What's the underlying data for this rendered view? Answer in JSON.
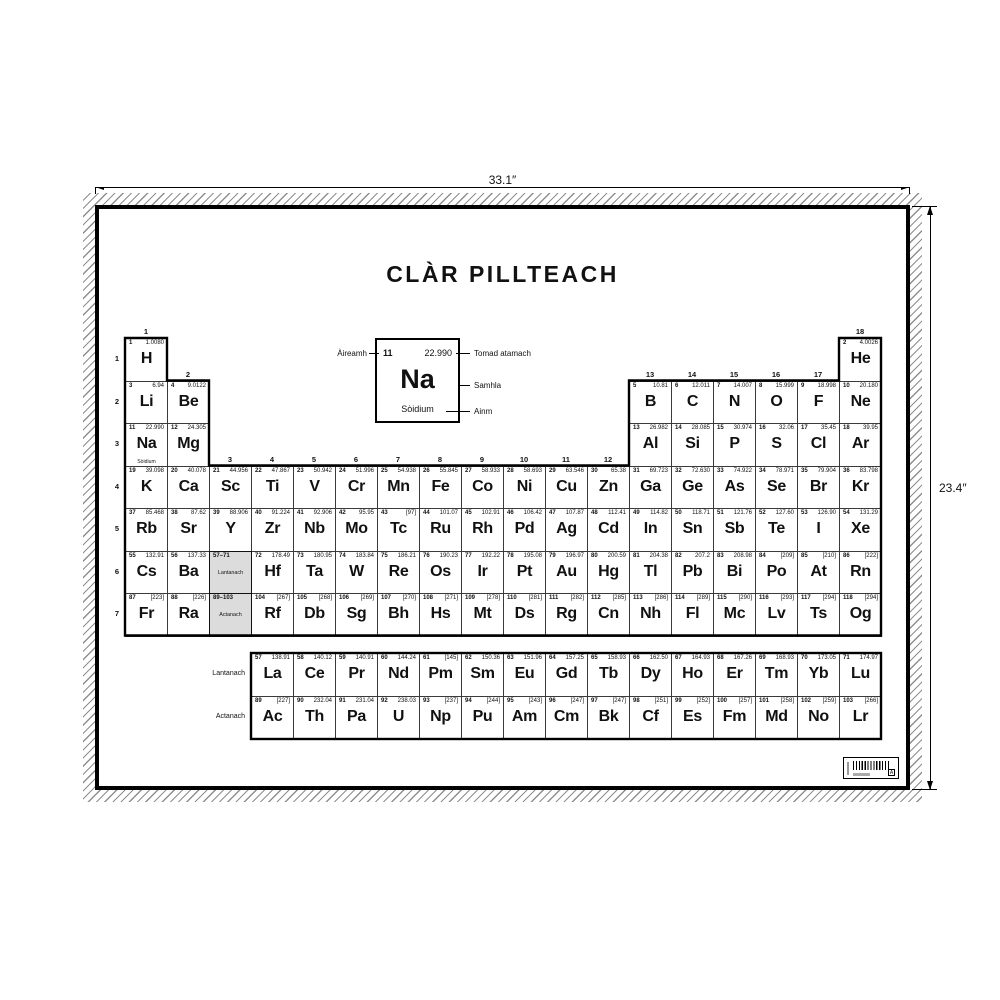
{
  "poster": {
    "title": "CLÀR PILLTEACH",
    "width_label": "33.1″",
    "height_label": "23.4″"
  },
  "legend": {
    "number": "11",
    "mass": "22.990",
    "symbol": "Na",
    "name": "Sòidium",
    "number_label": "Àireamh",
    "mass_label": "Tomad atamach",
    "symbol_label": "Samhla",
    "name_label": "Ainm"
  },
  "table": {
    "period_labels": [
      "1",
      "2",
      "3",
      "4",
      "5",
      "6",
      "7"
    ],
    "group_labels": [
      {
        "g": "1",
        "c": 1,
        "r": 1
      },
      {
        "g": "18",
        "c": 18,
        "r": 1
      },
      {
        "g": "2",
        "c": 2,
        "r": 2
      },
      {
        "g": "13",
        "c": 13,
        "r": 2
      },
      {
        "g": "14",
        "c": 14,
        "r": 2
      },
      {
        "g": "15",
        "c": 15,
        "r": 2
      },
      {
        "g": "16",
        "c": 16,
        "r": 2
      },
      {
        "g": "17",
        "c": 17,
        "r": 2
      },
      {
        "g": "3",
        "c": 3,
        "r": 4
      },
      {
        "g": "4",
        "c": 4,
        "r": 4
      },
      {
        "g": "5",
        "c": 5,
        "r": 4
      },
      {
        "g": "6",
        "c": 6,
        "r": 4
      },
      {
        "g": "7",
        "c": 7,
        "r": 4
      },
      {
        "g": "8",
        "c": 8,
        "r": 4
      },
      {
        "g": "9",
        "c": 9,
        "r": 4
      },
      {
        "g": "10",
        "c": 10,
        "r": 4
      },
      {
        "g": "11",
        "c": 11,
        "r": 4
      },
      {
        "g": "12",
        "c": 12,
        "r": 4
      }
    ],
    "placeholders": [
      {
        "range": "57–71",
        "label": "Lantanach",
        "r": 6
      },
      {
        "range": "89–103",
        "label": "Actanach",
        "r": 7
      }
    ],
    "row_labels": {
      "lanthanide": "Lantanach",
      "actinide": "Actanach"
    },
    "elements": [
      {
        "n": 1,
        "s": "H",
        "m": "1.0080",
        "r": 1,
        "c": 1
      },
      {
        "n": 2,
        "s": "He",
        "m": "4.0026",
        "r": 1,
        "c": 18
      },
      {
        "n": 3,
        "s": "Li",
        "m": "6.94",
        "r": 2,
        "c": 1
      },
      {
        "n": 4,
        "s": "Be",
        "m": "9.0122",
        "r": 2,
        "c": 2
      },
      {
        "n": 5,
        "s": "B",
        "m": "10.81",
        "r": 2,
        "c": 13
      },
      {
        "n": 6,
        "s": "C",
        "m": "12.011",
        "r": 2,
        "c": 14
      },
      {
        "n": 7,
        "s": "N",
        "m": "14.007",
        "r": 2,
        "c": 15
      },
      {
        "n": 8,
        "s": "O",
        "m": "15.999",
        "r": 2,
        "c": 16
      },
      {
        "n": 9,
        "s": "F",
        "m": "18.998",
        "r": 2,
        "c": 17
      },
      {
        "n": 10,
        "s": "Ne",
        "m": "20.180",
        "r": 2,
        "c": 18
      },
      {
        "n": 11,
        "s": "Na",
        "m": "22.990",
        "r": 3,
        "c": 1,
        "name": "Sòidium"
      },
      {
        "n": 12,
        "s": "Mg",
        "m": "24.305",
        "r": 3,
        "c": 2
      },
      {
        "n": 13,
        "s": "Al",
        "m": "26.982",
        "r": 3,
        "c": 13
      },
      {
        "n": 14,
        "s": "Si",
        "m": "28.085",
        "r": 3,
        "c": 14
      },
      {
        "n": 15,
        "s": "P",
        "m": "30.974",
        "r": 3,
        "c": 15
      },
      {
        "n": 16,
        "s": "S",
        "m": "32.06",
        "r": 3,
        "c": 16
      },
      {
        "n": 17,
        "s": "Cl",
        "m": "35.45",
        "r": 3,
        "c": 17
      },
      {
        "n": 18,
        "s": "Ar",
        "m": "39.95",
        "r": 3,
        "c": 18
      },
      {
        "n": 19,
        "s": "K",
        "m": "39.098",
        "r": 4,
        "c": 1
      },
      {
        "n": 20,
        "s": "Ca",
        "m": "40.078",
        "r": 4,
        "c": 2
      },
      {
        "n": 21,
        "s": "Sc",
        "m": "44.956",
        "r": 4,
        "c": 3
      },
      {
        "n": 22,
        "s": "Ti",
        "m": "47.867",
        "r": 4,
        "c": 4
      },
      {
        "n": 23,
        "s": "V",
        "m": "50.942",
        "r": 4,
        "c": 5
      },
      {
        "n": 24,
        "s": "Cr",
        "m": "51.996",
        "r": 4,
        "c": 6
      },
      {
        "n": 25,
        "s": "Mn",
        "m": "54.938",
        "r": 4,
        "c": 7
      },
      {
        "n": 26,
        "s": "Fe",
        "m": "55.845",
        "r": 4,
        "c": 8
      },
      {
        "n": 27,
        "s": "Co",
        "m": "58.933",
        "r": 4,
        "c": 9
      },
      {
        "n": 28,
        "s": "Ni",
        "m": "58.693",
        "r": 4,
        "c": 10
      },
      {
        "n": 29,
        "s": "Cu",
        "m": "63.546",
        "r": 4,
        "c": 11
      },
      {
        "n": 30,
        "s": "Zn",
        "m": "65.38",
        "r": 4,
        "c": 12
      },
      {
        "n": 31,
        "s": "Ga",
        "m": "69.723",
        "r": 4,
        "c": 13
      },
      {
        "n": 32,
        "s": "Ge",
        "m": "72.630",
        "r": 4,
        "c": 14
      },
      {
        "n": 33,
        "s": "As",
        "m": "74.922",
        "r": 4,
        "c": 15
      },
      {
        "n": 34,
        "s": "Se",
        "m": "78.971",
        "r": 4,
        "c": 16
      },
      {
        "n": 35,
        "s": "Br",
        "m": "79.904",
        "r": 4,
        "c": 17
      },
      {
        "n": 36,
        "s": "Kr",
        "m": "83.798",
        "r": 4,
        "c": 18
      },
      {
        "n": 37,
        "s": "Rb",
        "m": "85.468",
        "r": 5,
        "c": 1
      },
      {
        "n": 38,
        "s": "Sr",
        "m": "87.62",
        "r": 5,
        "c": 2
      },
      {
        "n": 39,
        "s": "Y",
        "m": "88.906",
        "r": 5,
        "c": 3
      },
      {
        "n": 40,
        "s": "Zr",
        "m": "91.224",
        "r": 5,
        "c": 4
      },
      {
        "n": 41,
        "s": "Nb",
        "m": "92.906",
        "r": 5,
        "c": 5
      },
      {
        "n": 42,
        "s": "Mo",
        "m": "95.95",
        "r": 5,
        "c": 6
      },
      {
        "n": 43,
        "s": "Tc",
        "m": "[97]",
        "r": 5,
        "c": 7
      },
      {
        "n": 44,
        "s": "Ru",
        "m": "101.07",
        "r": 5,
        "c": 8
      },
      {
        "n": 45,
        "s": "Rh",
        "m": "102.91",
        "r": 5,
        "c": 9
      },
      {
        "n": 46,
        "s": "Pd",
        "m": "106.42",
        "r": 5,
        "c": 10
      },
      {
        "n": 47,
        "s": "Ag",
        "m": "107.87",
        "r": 5,
        "c": 11
      },
      {
        "n": 48,
        "s": "Cd",
        "m": "112.41",
        "r": 5,
        "c": 12
      },
      {
        "n": 49,
        "s": "In",
        "m": "114.82",
        "r": 5,
        "c": 13
      },
      {
        "n": 50,
        "s": "Sn",
        "m": "118.71",
        "r": 5,
        "c": 14
      },
      {
        "n": 51,
        "s": "Sb",
        "m": "121.76",
        "r": 5,
        "c": 15
      },
      {
        "n": 52,
        "s": "Te",
        "m": "127.60",
        "r": 5,
        "c": 16
      },
      {
        "n": 53,
        "s": "I",
        "m": "126.90",
        "r": 5,
        "c": 17
      },
      {
        "n": 54,
        "s": "Xe",
        "m": "131.29",
        "r": 5,
        "c": 18
      },
      {
        "n": 55,
        "s": "Cs",
        "m": "132.91",
        "r": 6,
        "c": 1
      },
      {
        "n": 56,
        "s": "Ba",
        "m": "137.33",
        "r": 6,
        "c": 2
      },
      {
        "n": 72,
        "s": "Hf",
        "m": "178.49",
        "r": 6,
        "c": 4
      },
      {
        "n": 73,
        "s": "Ta",
        "m": "180.95",
        "r": 6,
        "c": 5
      },
      {
        "n": 74,
        "s": "W",
        "m": "183.84",
        "r": 6,
        "c": 6
      },
      {
        "n": 75,
        "s": "Re",
        "m": "186.21",
        "r": 6,
        "c": 7
      },
      {
        "n": 76,
        "s": "Os",
        "m": "190.23",
        "r": 6,
        "c": 8
      },
      {
        "n": 77,
        "s": "Ir",
        "m": "192.22",
        "r": 6,
        "c": 9
      },
      {
        "n": 78,
        "s": "Pt",
        "m": "195.08",
        "r": 6,
        "c": 10
      },
      {
        "n": 79,
        "s": "Au",
        "m": "196.97",
        "r": 6,
        "c": 11
      },
      {
        "n": 80,
        "s": "Hg",
        "m": "200.59",
        "r": 6,
        "c": 12
      },
      {
        "n": 81,
        "s": "Tl",
        "m": "204.38",
        "r": 6,
        "c": 13
      },
      {
        "n": 82,
        "s": "Pb",
        "m": "207.2",
        "r": 6,
        "c": 14
      },
      {
        "n": 83,
        "s": "Bi",
        "m": "208.98",
        "r": 6,
        "c": 15
      },
      {
        "n": 84,
        "s": "Po",
        "m": "[209]",
        "r": 6,
        "c": 16
      },
      {
        "n": 85,
        "s": "At",
        "m": "[210]",
        "r": 6,
        "c": 17
      },
      {
        "n": 86,
        "s": "Rn",
        "m": "[222]",
        "r": 6,
        "c": 18
      },
      {
        "n": 87,
        "s": "Fr",
        "m": "[223]",
        "r": 7,
        "c": 1
      },
      {
        "n": 88,
        "s": "Ra",
        "m": "[226]",
        "r": 7,
        "c": 2
      },
      {
        "n": 104,
        "s": "Rf",
        "m": "[267]",
        "r": 7,
        "c": 4
      },
      {
        "n": 105,
        "s": "Db",
        "m": "[268]",
        "r": 7,
        "c": 5
      },
      {
        "n": 106,
        "s": "Sg",
        "m": "[269]",
        "r": 7,
        "c": 6
      },
      {
        "n": 107,
        "s": "Bh",
        "m": "[270]",
        "r": 7,
        "c": 7
      },
      {
        "n": 108,
        "s": "Hs",
        "m": "[271]",
        "r": 7,
        "c": 8
      },
      {
        "n": 109,
        "s": "Mt",
        "m": "[278]",
        "r": 7,
        "c": 9
      },
      {
        "n": 110,
        "s": "Ds",
        "m": "[281]",
        "r": 7,
        "c": 10
      },
      {
        "n": 111,
        "s": "Rg",
        "m": "[282]",
        "r": 7,
        "c": 11
      },
      {
        "n": 112,
        "s": "Cn",
        "m": "[285]",
        "r": 7,
        "c": 12
      },
      {
        "n": 113,
        "s": "Nh",
        "m": "[286]",
        "r": 7,
        "c": 13
      },
      {
        "n": 114,
        "s": "Fl",
        "m": "[289]",
        "r": 7,
        "c": 14
      },
      {
        "n": 115,
        "s": "Mc",
        "m": "[290]",
        "r": 7,
        "c": 15
      },
      {
        "n": 116,
        "s": "Lv",
        "m": "[293]",
        "r": 7,
        "c": 16
      },
      {
        "n": 117,
        "s": "Ts",
        "m": "[294]",
        "r": 7,
        "c": 17
      },
      {
        "n": 118,
        "s": "Og",
        "m": "[294]",
        "r": 7,
        "c": 18
      }
    ],
    "lanthanides": [
      {
        "n": 57,
        "s": "La",
        "m": "138.91"
      },
      {
        "n": 58,
        "s": "Ce",
        "m": "140.12"
      },
      {
        "n": 59,
        "s": "Pr",
        "m": "140.91"
      },
      {
        "n": 60,
        "s": "Nd",
        "m": "144.24"
      },
      {
        "n": 61,
        "s": "Pm",
        "m": "[145]"
      },
      {
        "n": 62,
        "s": "Sm",
        "m": "150.36"
      },
      {
        "n": 63,
        "s": "Eu",
        "m": "151.96"
      },
      {
        "n": 64,
        "s": "Gd",
        "m": "157.25"
      },
      {
        "n": 65,
        "s": "Tb",
        "m": "158.93"
      },
      {
        "n": 66,
        "s": "Dy",
        "m": "162.50"
      },
      {
        "n": 67,
        "s": "Ho",
        "m": "164.93"
      },
      {
        "n": 68,
        "s": "Er",
        "m": "167.26"
      },
      {
        "n": 69,
        "s": "Tm",
        "m": "168.93"
      },
      {
        "n": 70,
        "s": "Yb",
        "m": "173.05"
      },
      {
        "n": 71,
        "s": "Lu",
        "m": "174.97"
      }
    ],
    "actinides": [
      {
        "n": 89,
        "s": "Ac",
        "m": "[227]"
      },
      {
        "n": 90,
        "s": "Th",
        "m": "232.04"
      },
      {
        "n": 91,
        "s": "Pa",
        "m": "231.04"
      },
      {
        "n": 92,
        "s": "U",
        "m": "238.03"
      },
      {
        "n": 93,
        "s": "Np",
        "m": "[237]"
      },
      {
        "n": 94,
        "s": "Pu",
        "m": "[244]"
      },
      {
        "n": 95,
        "s": "Am",
        "m": "[243]"
      },
      {
        "n": 96,
        "s": "Cm",
        "m": "[247]"
      },
      {
        "n": 97,
        "s": "Bk",
        "m": "[247]"
      },
      {
        "n": 98,
        "s": "Cf",
        "m": "[251]"
      },
      {
        "n": 99,
        "s": "Es",
        "m": "[252]"
      },
      {
        "n": 100,
        "s": "Fm",
        "m": "[257]"
      },
      {
        "n": 101,
        "s": "Md",
        "m": "[258]"
      },
      {
        "n": 102,
        "s": "No",
        "m": "[259]"
      },
      {
        "n": 103,
        "s": "Lr",
        "m": "[266]"
      }
    ]
  },
  "barcode": {
    "boxed_char": "A"
  },
  "colors": {
    "ink": "#111111",
    "placeholder_bg": "#dcdcdc",
    "hatch": "#8f8f8f"
  }
}
